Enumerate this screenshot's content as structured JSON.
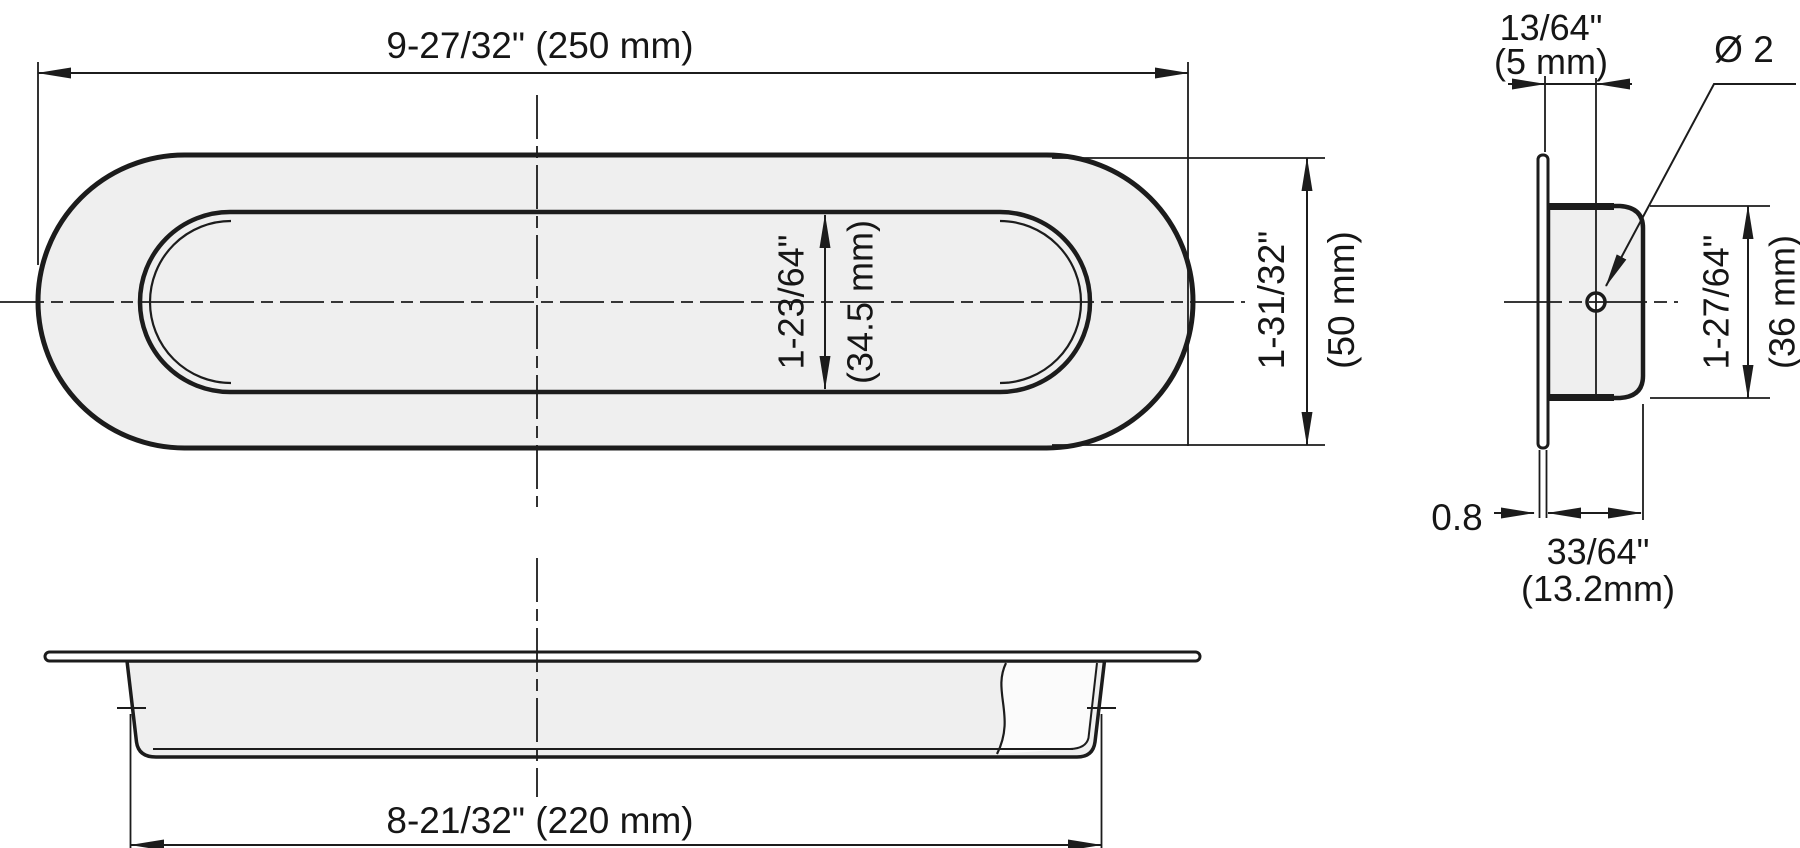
{
  "drawing": {
    "title": "flush-pull-handle-technical-drawing",
    "colors": {
      "line": "#1c1c1c",
      "part_fill": "#efefef",
      "background": "#ffffff"
    },
    "front_view": {
      "length_label": "9-27/32\" (250 mm)",
      "recess_width_in": "1-23/64\"",
      "recess_width_mm": "(34.5 mm)",
      "height_in": "1-31/32\"",
      "height_mm": "(50 mm)"
    },
    "section_view": {
      "inner_length_label": "8-21/32\" (220 mm)"
    },
    "side_view": {
      "hole_offset_in": "13/64\"",
      "hole_offset_mm": "(5 mm)",
      "hole_diameter_label": "Ø 2",
      "height_in": "1-27/64\"",
      "height_mm": "(36 mm)",
      "flange_thickness": "0.8",
      "depth_in": "33/64\"",
      "depth_mm": "(13.2mm)"
    }
  }
}
